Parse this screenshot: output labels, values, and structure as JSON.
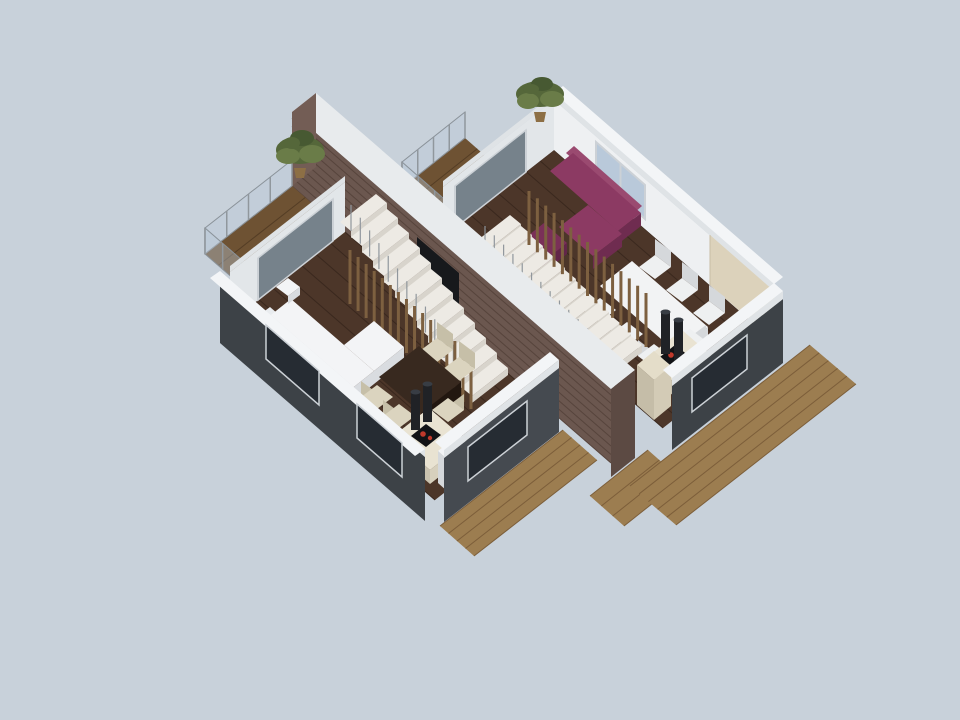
{
  "meta": {
    "description": "3D isometric cutaway rendering of a semi-detached house floor: two mirrored living units separated by a brick party wall, each with living room sofa, dining table, kitchen island with cooktop and extractor hoods, staircase with slat screen, balcony with glass railing and plants, surrounded by wooden decks on a light blue-gray background"
  },
  "scene": {
    "background": "light blue-gray studio backdrop",
    "units": [
      {
        "name": "left-unit",
        "furniture": [
          "white-sectional-sofa",
          "white-ottoman",
          "dark-wood-dining-table",
          "cream-chairs",
          "kitchen-island-with-cooktop",
          "extractor-hoods",
          "white-cabinet",
          "staircase",
          "wood-slat-screen",
          "balcony-with-plant"
        ]
      },
      {
        "name": "right-unit",
        "furniture": [
          "purple-sectional-sofa",
          "purple-ottoman",
          "white-dining-table",
          "white-chairs",
          "kitchen-island-with-cooktop",
          "extractor-hoods",
          "beige-cabinet",
          "staircase",
          "wood-slat-screen",
          "balcony-with-plant"
        ]
      }
    ],
    "shared": [
      "brick-party-wall",
      "fireplace-niche",
      "wooden-decks",
      "glass-railings",
      "plants"
    ]
  },
  "colors": {
    "bg": "#c8d1da",
    "floorWood": "#4c3629",
    "plankLine": "#3a281e",
    "balconyWood": "#6e5233",
    "balconyPlank": "#543d25",
    "deck": "#9c7d50",
    "deckPlank": "#7c5e3a",
    "wallWhiteFace": "#eef0f2",
    "wallWhiteShade": "#e2e6e9",
    "trimLight": "#dfe3e6",
    "trimTop": "#f3f5f7",
    "extDark": "#3d4247",
    "extDark2": "#454a50",
    "glassDark": "#41505baa",
    "glassSky": "#b9c9da",
    "windowDark": "#262c33",
    "frame": "#ccd1d6",
    "railGlass": "#b9c9d866",
    "railFrame": "#8a9299",
    "brick": "#6b574f",
    "brickLine": "#57443c",
    "brickCap": "#e8ebed",
    "brickEnd": "#5c4a43",
    "brickEnd2": "#735d55",
    "niche": "#17191c",
    "stairTread": "#edeae4",
    "stairRiser": "#d8d4cc",
    "baluster": "#90979d",
    "slatWood": "#7d6040",
    "sofaWhiteTop": "#f3f4f6",
    "sofaWhiteSide": "#d9dce0",
    "sofaWhiteBack": "#e9ecef",
    "sofaPurpleTop": "#8c3a63",
    "sofaPurpleSide": "#6f2c50",
    "sofaPurpleBack": "#9a4a70",
    "ottomanPurple": "#7a3058",
    "ottomanPurpleSide": "#622649",
    "tableDarkTop": "#38291f",
    "tableDarkSide": "#221710",
    "tableWhiteTop": "#f2f3f4",
    "tableWhiteSide": "#d7dadd",
    "chairCream": "#dbd4bf",
    "chairCreamSide": "#c6bfa8",
    "chairWhite": "#eef0f1",
    "chairWhiteSide": "#d5d8db",
    "islandTop": "#e9e3d2",
    "islandSide": "#d7d0bd",
    "islandSideSW": "#c9c2af",
    "panelBeige": "#dcd2bb",
    "panelSeam": "#c8bda4",
    "cabinetBeigeTop": "#e4ddc9",
    "cabinetBeigeSE": "#d3cbb6",
    "cabinetBeigeSW": "#c5bda8",
    "cooktop": "#121316",
    "burner": "#c0392b",
    "hood": "#202226",
    "hoodTop": "#383d44",
    "pot": "#8d6f45",
    "plant1": "#55673a",
    "plant2": "#6a7c48",
    "plant3": "#475932"
  },
  "decor": {
    "lines": {
      "leftDeckPlanks": {
        "r1": [
          [
            440,
            526
          ],
          [
            474,
            556
          ]
        ],
        "r2": [
          [
            563,
            430
          ],
          [
            597,
            460
          ]
        ],
        "n": 5,
        "color": "deckPlank",
        "w": 1,
        "name": "deck-plank-line"
      },
      "midDeckPlanks": {
        "r1": [
          [
            590,
            496
          ],
          [
            624,
            526
          ]
        ],
        "r2": [
          [
            648,
            450
          ],
          [
            682,
            480
          ]
        ],
        "n": 4,
        "color": "deckPlank",
        "w": 1,
        "name": "deck-plank-line"
      },
      "rightDeckPlanks": {
        "r1": [
          [
            630,
            486
          ],
          [
            676,
            525
          ]
        ],
        "r2": [
          [
            810,
            345
          ],
          [
            856,
            384
          ]
        ],
        "n": 6,
        "color": "deckPlank",
        "w": 1,
        "name": "deck-plank-line"
      },
      "rightFloorPlanks": {
        "r1": [
          [
            443,
            237
          ],
          [
            554,
            150
          ]
        ],
        "r2": [
          [
            663,
            428
          ],
          [
            774,
            341
          ]
        ],
        "n": 9,
        "color": "plankLine",
        "w": 1,
        "name": "floor-plank-line"
      },
      "rightBalconyPlanks": {
        "r1": [
          [
            402,
            188
          ],
          [
            451,
            231
          ]
        ],
        "r2": [
          [
            465,
            138
          ],
          [
            514,
            181
          ]
        ],
        "n": 5,
        "color": "balconyPlank",
        "w": 1,
        "name": "balcony-plank-line"
      },
      "railPostsR1": {
        "r1": [
          [
            402,
            188
          ],
          [
            465,
            138
          ]
        ],
        "r2": [
          [
            402,
            162
          ],
          [
            465,
            112
          ]
        ],
        "n": 5,
        "color": "baluster",
        "w": 1.5,
        "name": "railing-post"
      },
      "railPostsR2": {
        "r1": [
          [
            402,
            188
          ],
          [
            451,
            231
          ]
        ],
        "r2": [
          [
            402,
            162
          ],
          [
            451,
            205
          ]
        ],
        "n": 4,
        "color": "baluster",
        "w": 1.5,
        "name": "railing-post"
      },
      "doorMullionsRight": {
        "r1": [
          [
            455,
            228
          ],
          [
            526,
            172
          ]
        ],
        "r2": [
          [
            455,
            186
          ],
          [
            526,
            130
          ]
        ],
        "n": 2,
        "color": "frame",
        "w": 2,
        "name": "door-mullion"
      },
      "windowMullionRight": {
        "r1": [
          [
            596,
            176
          ],
          [
            645,
            219
          ]
        ],
        "r2": [
          [
            596,
            142
          ],
          [
            645,
            185
          ]
        ],
        "n": 1,
        "color": "frame",
        "w": 2,
        "name": "window-mullion"
      },
      "panelSeams": {
        "r1": [
          [
            710,
            285
          ],
          [
            774,
            341
          ]
        ],
        "r2": [
          [
            710,
            235
          ],
          [
            774,
            291
          ]
        ],
        "n": 2,
        "color": "panelSeam",
        "w": 1,
        "name": "panel-seam"
      },
      "rightBalusters": {
        "r1": [
          [
            606,
            373
          ],
          [
            485,
            252
          ]
        ],
        "r2": [
          [
            606,
            347
          ],
          [
            485,
            226
          ]
        ],
        "n": 14,
        "color": "baluster",
        "w": 1.2,
        "name": "stair-baluster"
      },
      "rightSlats": {
        "r1": [
          [
            529,
            245
          ],
          [
            646,
            347
          ]
        ],
        "r2": [
          [
            529,
            191
          ],
          [
            646,
            293
          ]
        ],
        "n": 15,
        "color": "slatWood",
        "w": 3,
        "name": "wood-slat"
      },
      "brickCourses": {
        "r1": [
          [
            292,
            118
          ],
          [
            292,
            186
          ]
        ],
        "r2": [
          [
            611,
            395
          ],
          [
            611,
            463
          ]
        ],
        "n": 9,
        "color": "brickLine",
        "w": 1,
        "name": "brick-course-line"
      },
      "leftFloorPlanks": {
        "r1": [
          [
            230,
            322
          ],
          [
            345,
            232
          ]
        ],
        "r2": [
          [
            435,
            500
          ],
          [
            550,
            410
          ]
        ],
        "n": 9,
        "color": "plankLine",
        "w": 1,
        "name": "floor-plank-line"
      },
      "leftBalconyPlanks": {
        "r1": [
          [
            205,
            254
          ],
          [
            258,
            300
          ]
        ],
        "r2": [
          [
            292,
            186
          ],
          [
            345,
            232
          ]
        ],
        "n": 5,
        "color": "balconyPlank",
        "w": 1,
        "name": "balcony-plank-line"
      },
      "railPostsL1": {
        "r1": [
          [
            205,
            254
          ],
          [
            292,
            186
          ]
        ],
        "r2": [
          [
            205,
            228
          ],
          [
            292,
            160
          ]
        ],
        "n": 5,
        "color": "baluster",
        "w": 1.5,
        "name": "railing-post"
      },
      "railPostsL2": {
        "r1": [
          [
            205,
            254
          ],
          [
            258,
            300
          ]
        ],
        "r2": [
          [
            205,
            228
          ],
          [
            258,
            274
          ]
        ],
        "n": 4,
        "color": "baluster",
        "w": 1.5,
        "name": "railing-post"
      },
      "doorMullionsLeft": {
        "r1": [
          [
            258,
            300
          ],
          [
            333,
            241
          ]
        ],
        "r2": [
          [
            258,
            258
          ],
          [
            333,
            199
          ]
        ],
        "n": 2,
        "color": "frame",
        "w": 2,
        "name": "door-mullion"
      },
      "leftBalusters": {
        "r1": [
          [
            472,
            396
          ],
          [
            351,
            231
          ]
        ],
        "r2": [
          [
            472,
            370
          ],
          [
            351,
            205
          ]
        ],
        "n": 14,
        "color": "baluster",
        "w": 1.2,
        "name": "stair-baluster"
      },
      "leftSlats": {
        "r1": [
          [
            350,
            304
          ],
          [
            471,
            409
          ]
        ],
        "r2": [
          [
            350,
            250
          ],
          [
            471,
            355
          ]
        ],
        "n": 16,
        "color": "slatWood",
        "w": 3,
        "name": "wood-slat"
      }
    },
    "stairs": {
      "rightStairs": {
        "p0": [
          606,
          373
        ],
        "du": [
          36,
          -28
        ],
        "dv": [
          -11,
          -9
        ],
        "step": [
          -11,
          -11
        ],
        "n": 12,
        "riserH": 7,
        "treadColor": "stairTread",
        "riserColor": "stairRiser"
      },
      "leftStairs": {
        "p0": [
          472,
          396
        ],
        "du": [
          36,
          -28
        ],
        "dv": [
          -11,
          -9
        ],
        "step": [
          -11,
          -15
        ],
        "n": 12,
        "riserH": 7,
        "treadColor": "stairTread",
        "riserColor": "stairRiser"
      }
    }
  }
}
